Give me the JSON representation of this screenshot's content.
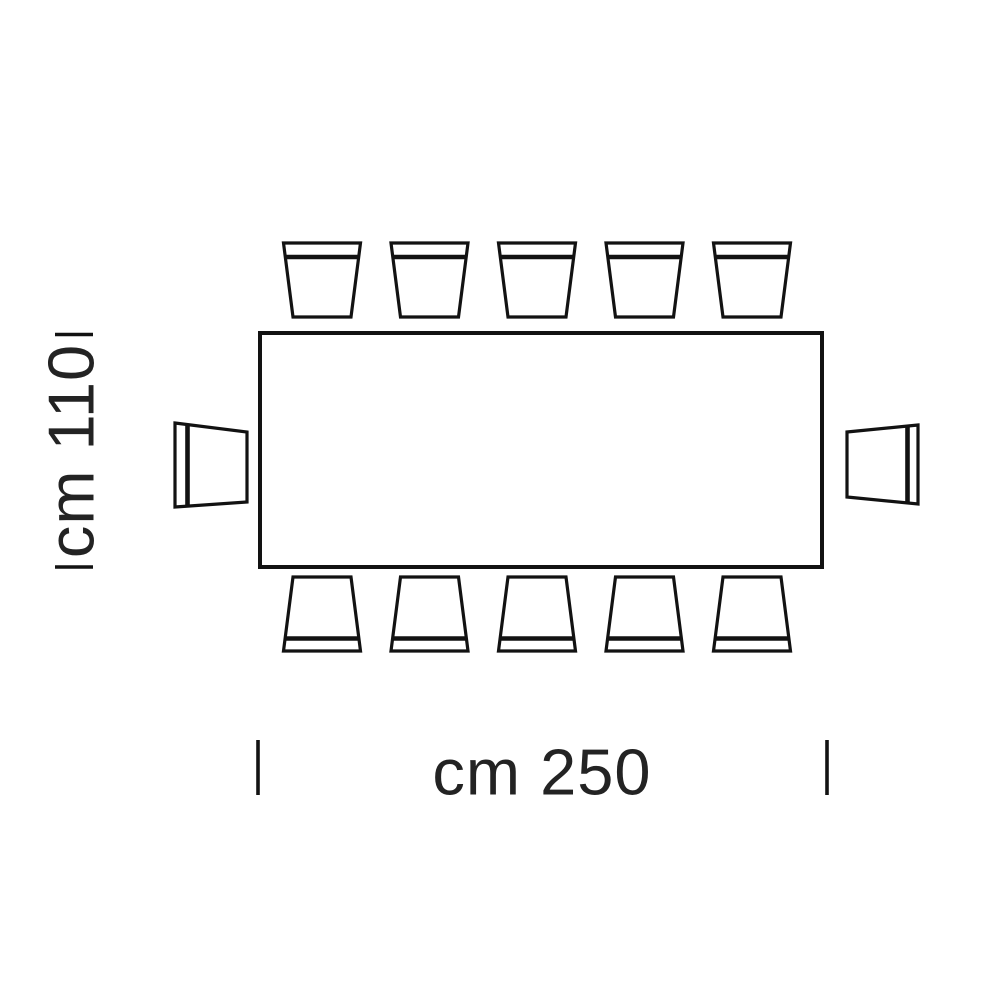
{
  "diagram": {
    "type": "furniture-dimension-top-view",
    "subject": "rectangular dining table with twelve chairs, plan view",
    "labels": {
      "width": "cm 250",
      "depth": "cm 110"
    },
    "dimensions": {
      "width_cm": 250,
      "depth_cm": 110,
      "unit": "cm"
    },
    "table": {
      "shape": "rectangle"
    },
    "chairs": {
      "top_count": 5,
      "bottom_count": 5,
      "left_count": 1,
      "right_count": 1,
      "total": 12
    },
    "colors": {
      "line": "#121212",
      "text": "#232323",
      "background": "#ffffff"
    }
  }
}
